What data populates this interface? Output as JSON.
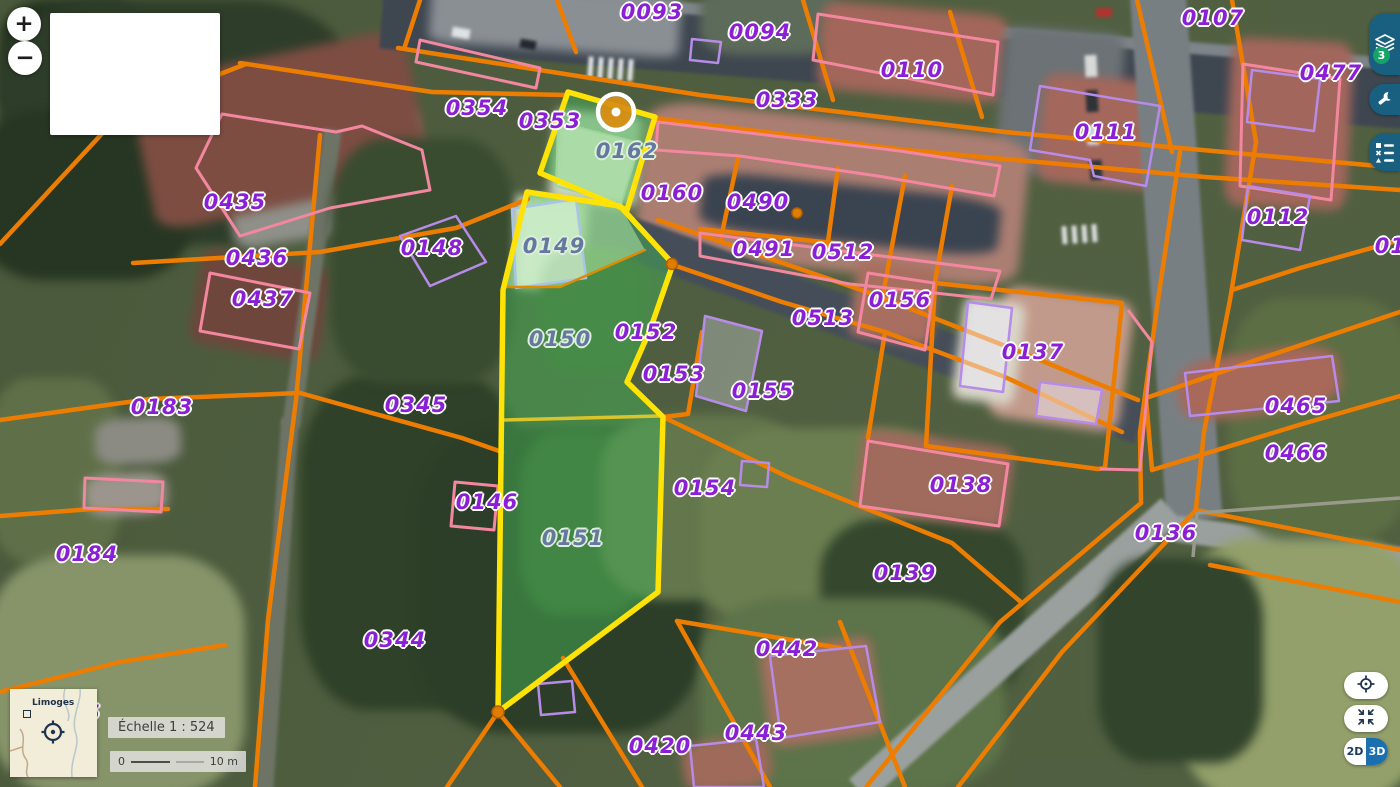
{
  "app": {
    "type": "cadastral-map-viewer"
  },
  "controls": {
    "zoom_in": "+",
    "zoom_out": "−",
    "layers_badge": "3",
    "dim_2d": "2D",
    "dim_3d": "3D"
  },
  "minimap": {
    "city": "Limoges"
  },
  "scale": {
    "label": "Échelle 1 : 524",
    "bar_start": "0",
    "bar_end": "10 m"
  },
  "colors": {
    "boundary_orange": "#ed7d00",
    "selection_yellow": "#ffe206",
    "selection_green_fill": "rgba(70,175,85,0.5)",
    "label_purple": "#8a1fd6",
    "label_muted": "#64799f",
    "building_pink": "#f2879f",
    "building_purple": "#b78be8",
    "button_blue": "#195f80",
    "badge_green": "#17a269",
    "toggle_blue": "#1b6fae"
  },
  "marker": {
    "x": 616,
    "y": 112
  },
  "parcels": [
    {
      "number": "0093",
      "x": 652,
      "y": 12,
      "v": "p"
    },
    {
      "number": "0094",
      "x": 760,
      "y": 32,
      "v": "p"
    },
    {
      "number": "0107",
      "x": 1213,
      "y": 18,
      "v": "p"
    },
    {
      "number": "0110",
      "x": 912,
      "y": 70,
      "v": "p"
    },
    {
      "number": "0477",
      "x": 1331,
      "y": 73,
      "v": "p"
    },
    {
      "number": "0333",
      "x": 787,
      "y": 100,
      "v": "p"
    },
    {
      "number": "0354",
      "x": 477,
      "y": 108,
      "v": "p"
    },
    {
      "number": "0353",
      "x": 550,
      "y": 121,
      "v": "p"
    },
    {
      "number": "0111",
      "x": 1106,
      "y": 132,
      "v": "p"
    },
    {
      "number": "0162",
      "x": 627,
      "y": 151,
      "v": "m"
    },
    {
      "number": "0160",
      "x": 672,
      "y": 193,
      "v": "p"
    },
    {
      "number": "0490",
      "x": 758,
      "y": 202,
      "v": "p"
    },
    {
      "number": "0435",
      "x": 235,
      "y": 202,
      "v": "p"
    },
    {
      "number": "0112",
      "x": 1278,
      "y": 217,
      "v": "p"
    },
    {
      "number": "0113",
      "x": 1406,
      "y": 246,
      "v": "p"
    },
    {
      "number": "0148",
      "x": 432,
      "y": 248,
      "v": "p"
    },
    {
      "number": "0149",
      "x": 554,
      "y": 246,
      "v": "m"
    },
    {
      "number": "0491",
      "x": 764,
      "y": 249,
      "v": "p"
    },
    {
      "number": "0512",
      "x": 843,
      "y": 252,
      "v": "p"
    },
    {
      "number": "0436",
      "x": 257,
      "y": 258,
      "v": "p"
    },
    {
      "number": "0437",
      "x": 263,
      "y": 299,
      "v": "p"
    },
    {
      "number": "0156",
      "x": 900,
      "y": 300,
      "v": "p"
    },
    {
      "number": "0513",
      "x": 823,
      "y": 318,
      "v": "p"
    },
    {
      "number": "0152",
      "x": 646,
      "y": 332,
      "v": "p"
    },
    {
      "number": "0150",
      "x": 560,
      "y": 339,
      "v": "m"
    },
    {
      "number": "0137",
      "x": 1033,
      "y": 352,
      "v": "p"
    },
    {
      "number": "0153",
      "x": 674,
      "y": 374,
      "v": "p"
    },
    {
      "number": "0155",
      "x": 763,
      "y": 391,
      "v": "p"
    },
    {
      "number": "0345",
      "x": 416,
      "y": 405,
      "v": "p"
    },
    {
      "number": "0183",
      "x": 162,
      "y": 407,
      "v": "p"
    },
    {
      "number": "0465",
      "x": 1296,
      "y": 406,
      "v": "p"
    },
    {
      "number": "0466",
      "x": 1296,
      "y": 453,
      "v": "p"
    },
    {
      "number": "0138",
      "x": 961,
      "y": 485,
      "v": "p"
    },
    {
      "number": "0154",
      "x": 705,
      "y": 488,
      "v": "p"
    },
    {
      "number": "0146",
      "x": 487,
      "y": 502,
      "v": "p"
    },
    {
      "number": "0136",
      "x": 1166,
      "y": 533,
      "v": "p"
    },
    {
      "number": "0151",
      "x": 573,
      "y": 538,
      "v": "m"
    },
    {
      "number": "0184",
      "x": 87,
      "y": 554,
      "v": "p"
    },
    {
      "number": "0139",
      "x": 905,
      "y": 573,
      "v": "p"
    },
    {
      "number": "0344",
      "x": 395,
      "y": 640,
      "v": "p"
    },
    {
      "number": "0442",
      "x": 787,
      "y": 649,
      "v": "p"
    },
    {
      "number": "5",
      "x": 93,
      "y": 713,
      "v": "p"
    },
    {
      "number": "0443",
      "x": 756,
      "y": 733,
      "v": "p"
    },
    {
      "number": "0420",
      "x": 660,
      "y": 746,
      "v": "p"
    }
  ]
}
